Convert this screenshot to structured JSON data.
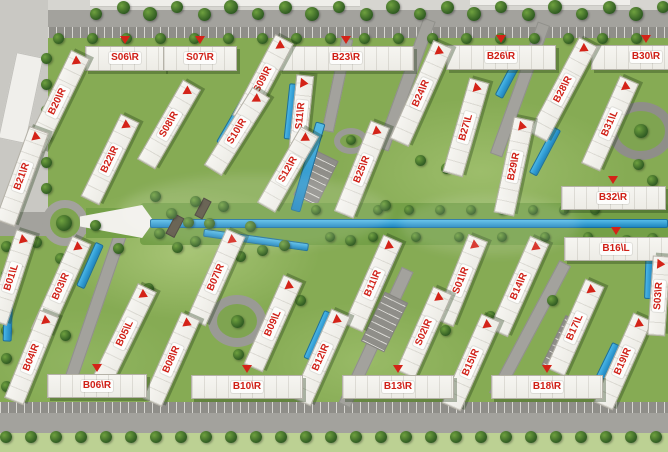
{
  "plan": {
    "type": "residential-compound-master-plan",
    "colors": {
      "label_red": "#d01f16",
      "building_white": "#f5f4f0",
      "grass_green": "#86ab54",
      "road_gray": "#a3a29d",
      "water_blue": "#2f9fd8",
      "tree_green": "#3c6b2c"
    },
    "buildings": [
      {
        "label": "S06\\R",
        "x": 125,
        "y": 58,
        "rot": 0,
        "len": 80,
        "w": 25
      },
      {
        "label": "S07\\R",
        "x": 200,
        "y": 58,
        "rot": 0,
        "len": 74,
        "w": 25
      },
      {
        "label": "B23\\R",
        "x": 346,
        "y": 58,
        "rot": 0,
        "len": 135,
        "w": 25
      },
      {
        "label": "B26\\R",
        "x": 501,
        "y": 57,
        "rot": 0,
        "len": 110,
        "w": 25
      },
      {
        "label": "B30\\R",
        "x": 646,
        "y": 57,
        "rot": 0,
        "len": 110,
        "w": 25
      },
      {
        "label": "B20\\R",
        "x": 57,
        "y": 101,
        "rot": -64,
        "len": 105,
        "w": 21
      },
      {
        "label": "S08\\R",
        "x": 169,
        "y": 124,
        "rot": -60,
        "len": 92,
        "w": 21
      },
      {
        "label": "S09\\R",
        "x": 263,
        "y": 79,
        "rot": -62,
        "len": 92,
        "w": 21
      },
      {
        "label": "S10\\R",
        "x": 237,
        "y": 131,
        "rot": -58,
        "len": 92,
        "w": 21
      },
      {
        "label": "S11\\R",
        "x": 301,
        "y": 116,
        "rot": -84,
        "len": 82,
        "w": 18
      },
      {
        "label": "S12\\R",
        "x": 288,
        "y": 169,
        "rot": -60,
        "len": 88,
        "w": 21
      },
      {
        "label": "B21\\R",
        "x": 22,
        "y": 176,
        "rot": -70,
        "len": 100,
        "w": 21
      },
      {
        "label": "B22\\R",
        "x": 110,
        "y": 159,
        "rot": -64,
        "len": 92,
        "w": 21
      },
      {
        "label": "B24\\R",
        "x": 421,
        "y": 93,
        "rot": -66,
        "len": 108,
        "w": 21
      },
      {
        "label": "B25\\R",
        "x": 362,
        "y": 169,
        "rot": -68,
        "len": 98,
        "w": 21
      },
      {
        "label": "B27\\L",
        "x": 466,
        "y": 127,
        "rot": -74,
        "len": 98,
        "w": 21
      },
      {
        "label": "B28\\R",
        "x": 563,
        "y": 89,
        "rot": -62,
        "len": 108,
        "w": 21
      },
      {
        "label": "B29\\R",
        "x": 514,
        "y": 166,
        "rot": -78,
        "len": 98,
        "w": 21
      },
      {
        "label": "B31\\L",
        "x": 610,
        "y": 123,
        "rot": -66,
        "len": 96,
        "w": 21
      },
      {
        "label": "B32\\R",
        "x": 613,
        "y": 198,
        "rot": 0,
        "len": 105,
        "w": 24
      },
      {
        "label": "B16\\L",
        "x": 616,
        "y": 249,
        "rot": 0,
        "len": 105,
        "w": 24
      },
      {
        "label": "B01\\L",
        "x": 11,
        "y": 277,
        "rot": -72,
        "len": 95,
        "w": 21
      },
      {
        "label": "B03\\R",
        "x": 61,
        "y": 286,
        "rot": -66,
        "len": 102,
        "w": 21
      },
      {
        "label": "B05\\L",
        "x": 125,
        "y": 333,
        "rot": -64,
        "len": 102,
        "w": 21
      },
      {
        "label": "B04\\R",
        "x": 31,
        "y": 357,
        "rot": -68,
        "len": 95,
        "w": 21
      },
      {
        "label": "B07\\R",
        "x": 216,
        "y": 277,
        "rot": -66,
        "len": 98,
        "w": 21
      },
      {
        "label": "B09\\L",
        "x": 273,
        "y": 323,
        "rot": -66,
        "len": 98,
        "w": 21
      },
      {
        "label": "B08\\R",
        "x": 171,
        "y": 359,
        "rot": -66,
        "len": 95,
        "w": 21
      },
      {
        "label": "B11\\R",
        "x": 373,
        "y": 283,
        "rot": -66,
        "len": 98,
        "w": 21
      },
      {
        "label": "B12\\R",
        "x": 321,
        "y": 357,
        "rot": -66,
        "len": 98,
        "w": 21
      },
      {
        "label": "S01\\R",
        "x": 461,
        "y": 280,
        "rot": -68,
        "len": 92,
        "w": 21
      },
      {
        "label": "S02\\R",
        "x": 424,
        "y": 332,
        "rot": -66,
        "len": 92,
        "w": 21
      },
      {
        "label": "B14\\R",
        "x": 519,
        "y": 286,
        "rot": -66,
        "len": 102,
        "w": 21
      },
      {
        "label": "B15\\R",
        "x": 471,
        "y": 362,
        "rot": -66,
        "len": 98,
        "w": 21
      },
      {
        "label": "B17\\L",
        "x": 575,
        "y": 327,
        "rot": -66,
        "len": 98,
        "w": 21
      },
      {
        "label": "B19\\R",
        "x": 623,
        "y": 361,
        "rot": -66,
        "len": 98,
        "w": 21
      },
      {
        "label": "S03\\R",
        "x": 659,
        "y": 296,
        "rot": -86,
        "len": 80,
        "w": 18
      },
      {
        "label": "B06\\R",
        "x": 97,
        "y": 386,
        "rot": 0,
        "len": 100,
        "w": 24
      },
      {
        "label": "B10\\R",
        "x": 247,
        "y": 387,
        "rot": 0,
        "len": 112,
        "w": 24
      },
      {
        "label": "B13\\R",
        "x": 398,
        "y": 387,
        "rot": 0,
        "len": 112,
        "w": 24
      },
      {
        "label": "B18\\R",
        "x": 547,
        "y": 387,
        "rot": 0,
        "len": 112,
        "w": 24
      }
    ]
  }
}
